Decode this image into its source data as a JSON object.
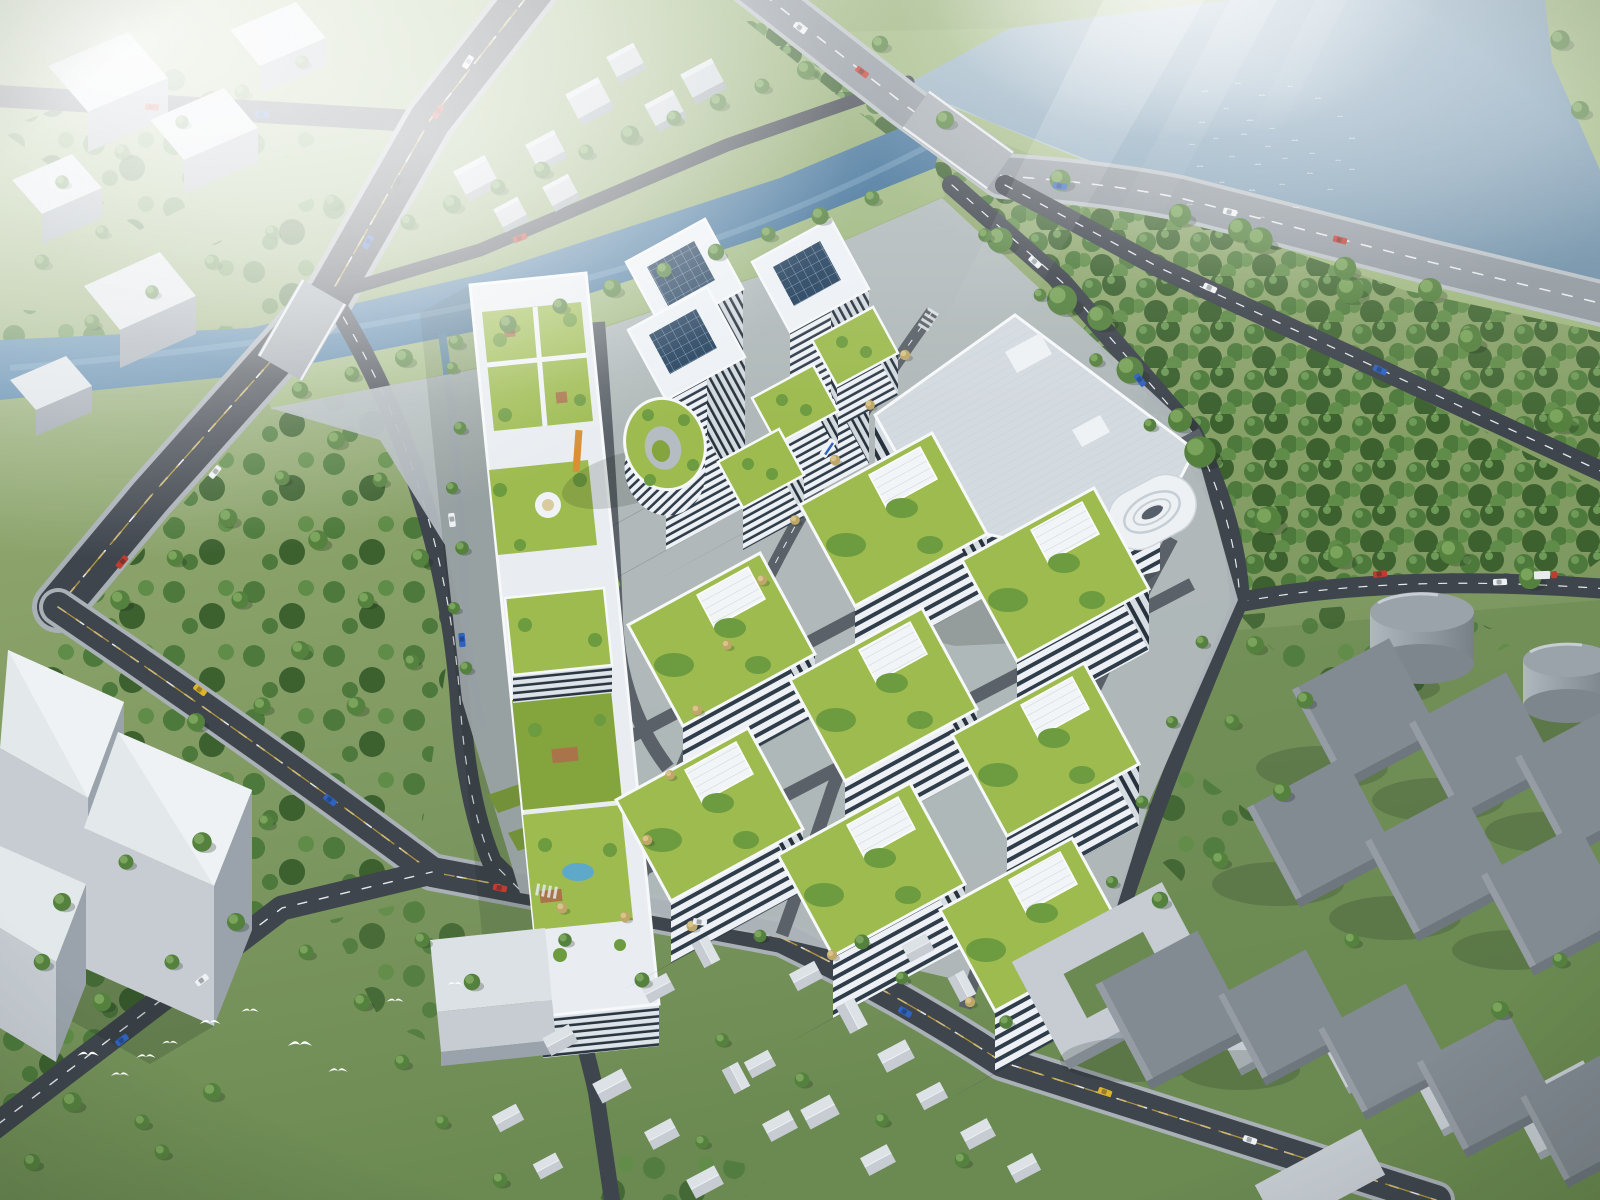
{
  "scene": {
    "kind": "aerial-architectural-rendering",
    "counts": {
      "campus_highrise_towers": 3,
      "green_roof_office_blocks": 8,
      "terraced_garden_blocks": 3,
      "courtyard_ring_buildings": 1,
      "factory_podium_buildings": 1,
      "storage_tanks": 2,
      "industrial_warehouses": 10,
      "context_towers_west": 3,
      "bird_flocks": 1
    }
  },
  "colors": {
    "grass": "#8ba36b",
    "grass_light": "#9eb77e",
    "grass_dark": "#6b8a52",
    "forest": "#4d7a3c",
    "forest_dark": "#3c612f",
    "forest_light": "#5f8c48",
    "tree": "#55813f",
    "tree_light": "#7aa45b",
    "tree_autumn": "#bfa769",
    "river": "#4a7da7",
    "river_deep": "#3f6f96",
    "lake": "#84a2b8",
    "lake_far": "#a7bcc9",
    "stream": "#5083a9",
    "asphalt": "#3f454d",
    "asphalt_dark": "#34393f",
    "road_light": "#8f979e",
    "road_line": "#e6e9ec",
    "lane_yellow": "#c9a93f",
    "sidewalk": "#a9b0b6",
    "paving": "#b2b9be",
    "plaza": "#c7ced4",
    "bldg_white": "#edf1f5",
    "parapet": "#f6f8fa",
    "glass": "#2f3c49",
    "glass_light": "#51636f",
    "green_roof": "#9dbb4f",
    "green_roof_dark": "#84a53e",
    "roof_tree": "#6d9b3f",
    "solar": "#223f5c",
    "solar_line": "#8fa9c2",
    "context": "#c6ccd2",
    "context_light": "#dde2e6",
    "context_side": "#9aa3ab",
    "context_dark": "#7f8890",
    "warehouse": "#828a92",
    "warehouse_dark": "#6e767e",
    "tank": "#9aa2aa",
    "tank_light": "#b0b8bf",
    "pool": "#5ea9c9",
    "deck": "#a9744a",
    "accent": "#d98f35",
    "car_red": "#c03b30",
    "car_blue": "#2f63c0",
    "car_yellow": "#dcb32b",
    "car_white": "#eef1f3",
    "car_dark": "#3a4148",
    "shadow": "#16241a",
    "haze": "#ffffff",
    "bird": "#ffffff"
  }
}
